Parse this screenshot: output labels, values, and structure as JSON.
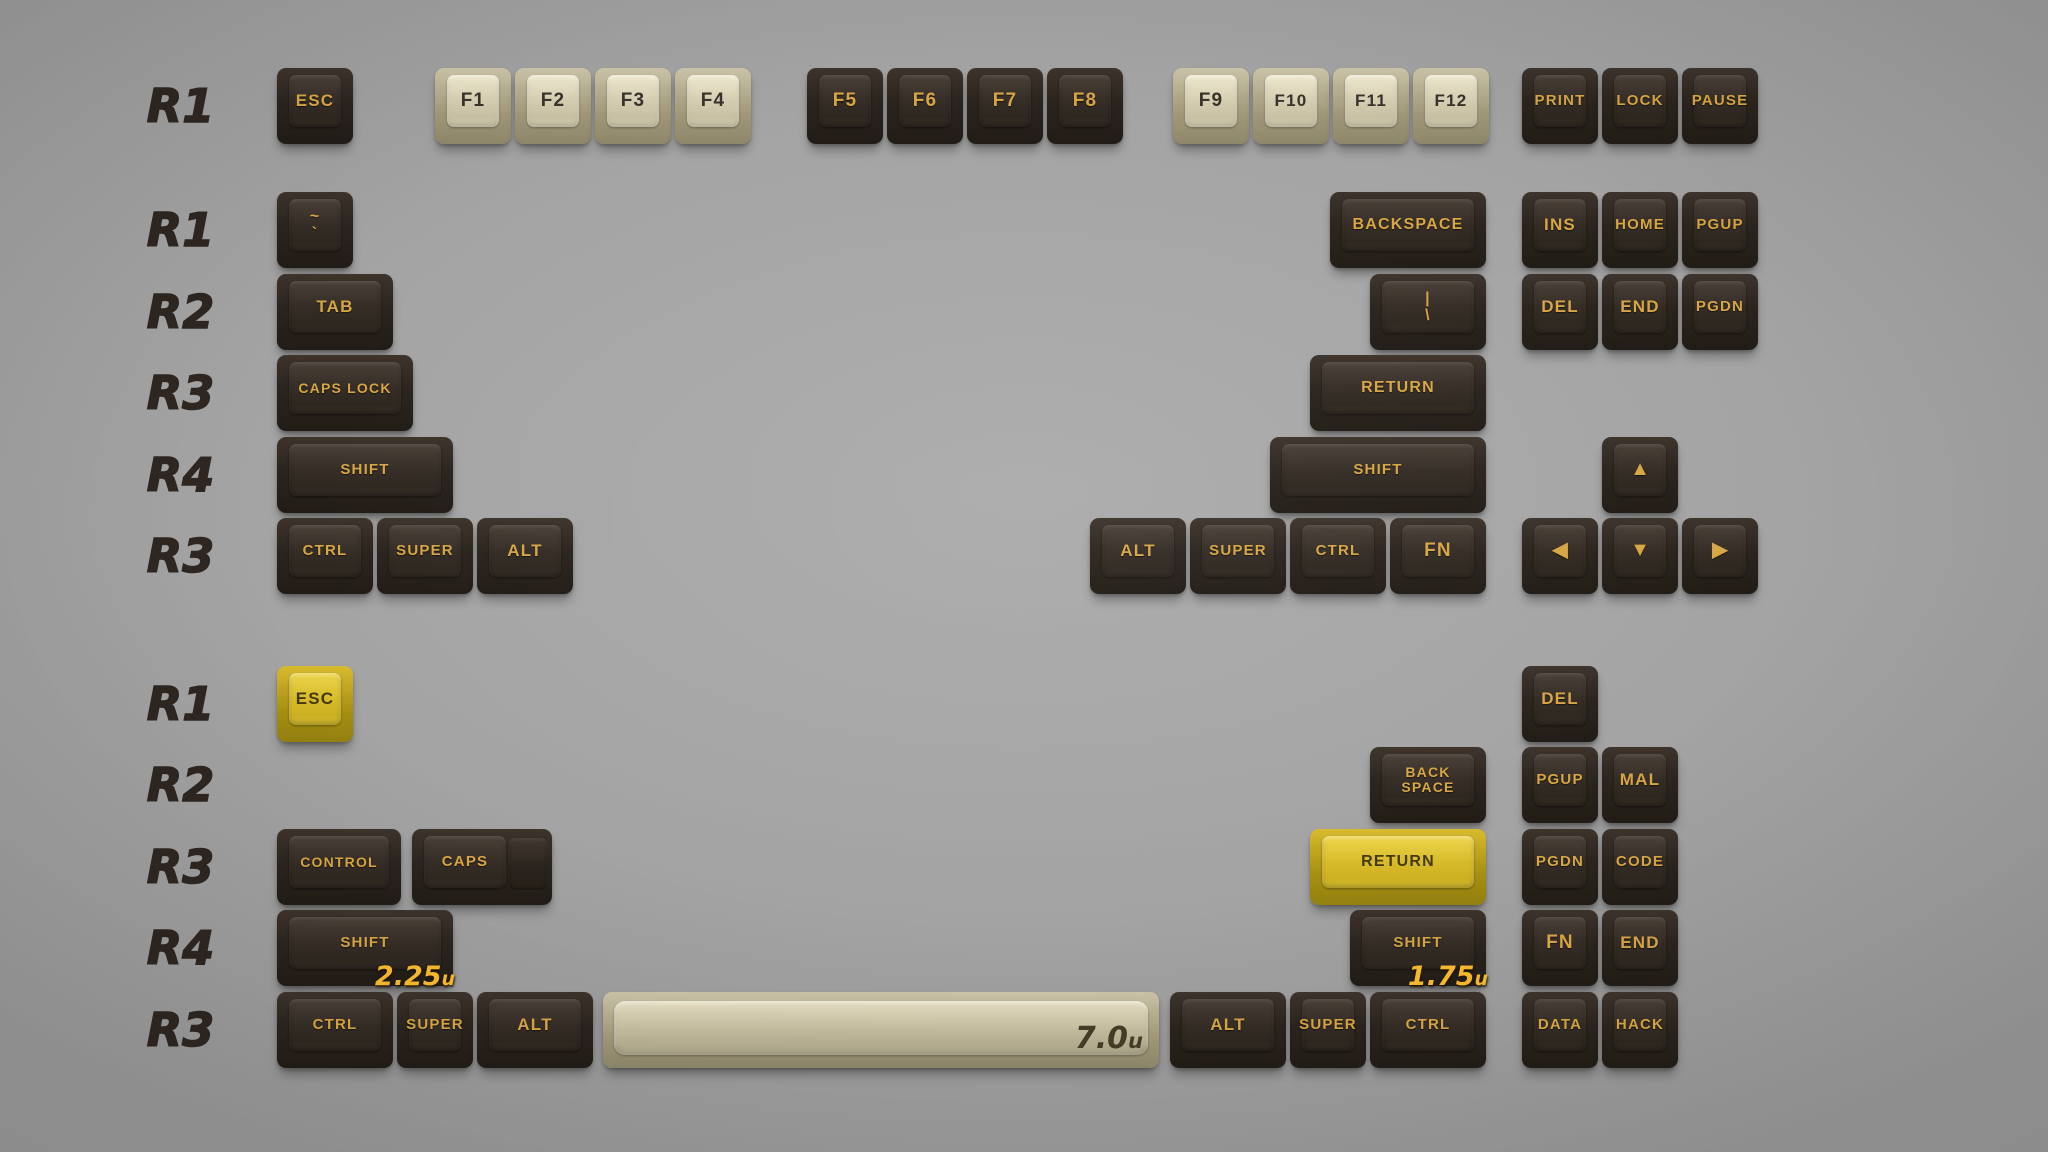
{
  "palette": {
    "background": "#9f9f9f",
    "dark_key": "#2b241e",
    "beige_key": "#d8d1b5",
    "yellow_key": "#dcc135",
    "legend_gold": "#d7a645",
    "legend_dark": "#3a332b",
    "row_label_color": "#2e2620",
    "annotation_yellow": "#f8ba2e",
    "annotation_dark": "#473c28"
  },
  "unit_px": 80,
  "key_height_px": 76,
  "rows": [
    {
      "label": "R1",
      "y": 68,
      "keys": [
        {
          "text": "ESC",
          "x": 277,
          "u": 1,
          "color": "dark"
        },
        {
          "text": "F1",
          "x": 435,
          "u": 1,
          "color": "beige"
        },
        {
          "text": "F2",
          "x": 515,
          "u": 1,
          "color": "beige"
        },
        {
          "text": "F3",
          "x": 595,
          "u": 1,
          "color": "beige"
        },
        {
          "text": "F4",
          "x": 675,
          "u": 1,
          "color": "beige"
        },
        {
          "text": "F5",
          "x": 807,
          "u": 1,
          "color": "dark"
        },
        {
          "text": "F6",
          "x": 887,
          "u": 1,
          "color": "dark"
        },
        {
          "text": "F7",
          "x": 967,
          "u": 1,
          "color": "dark"
        },
        {
          "text": "F8",
          "x": 1047,
          "u": 1,
          "color": "dark"
        },
        {
          "text": "F9",
          "x": 1173,
          "u": 1,
          "color": "beige"
        },
        {
          "text": "F10",
          "x": 1253,
          "u": 1,
          "color": "beige"
        },
        {
          "text": "F11",
          "x": 1333,
          "u": 1,
          "color": "beige"
        },
        {
          "text": "F12",
          "x": 1413,
          "u": 1,
          "color": "beige"
        },
        {
          "text": "PRINT",
          "x": 1522,
          "u": 1,
          "color": "dark"
        },
        {
          "text": "LOCK",
          "x": 1602,
          "u": 1,
          "color": "dark"
        },
        {
          "text": "PAUSE",
          "x": 1682,
          "u": 1,
          "color": "dark"
        }
      ]
    },
    {
      "label": "R1",
      "y": 192,
      "keys": [
        {
          "text": "~ `",
          "id": "tilde",
          "lines": [
            "~",
            "`"
          ],
          "x": 277,
          "u": 1,
          "color": "dark"
        },
        {
          "text": "BACKSPACE",
          "x": 1330,
          "u": 2,
          "color": "dark"
        },
        {
          "text": "INS",
          "x": 1522,
          "u": 1,
          "color": "dark"
        },
        {
          "text": "HOME",
          "x": 1602,
          "u": 1,
          "color": "dark"
        },
        {
          "text": "PGUP",
          "x": 1682,
          "u": 1,
          "color": "dark"
        }
      ]
    },
    {
      "label": "R2",
      "y": 274,
      "keys": [
        {
          "text": "TAB",
          "x": 277,
          "u": 1.5,
          "color": "dark"
        },
        {
          "text": "| \\",
          "id": "backslash",
          "lines": [
            "|",
            "\\"
          ],
          "x": 1370,
          "u": 1.5,
          "color": "dark"
        },
        {
          "text": "DEL",
          "x": 1522,
          "u": 1,
          "color": "dark"
        },
        {
          "text": "END",
          "x": 1602,
          "u": 1,
          "color": "dark"
        },
        {
          "text": "PGDN",
          "x": 1682,
          "u": 1,
          "color": "dark"
        }
      ]
    },
    {
      "label": "R3",
      "y": 355,
      "keys": [
        {
          "text": "CAPS LOCK",
          "x": 277,
          "u": 1.75,
          "color": "dark"
        },
        {
          "text": "RETURN",
          "x": 1310,
          "u": 2.25,
          "color": "dark"
        }
      ]
    },
    {
      "label": "R4",
      "y": 437,
      "keys": [
        {
          "text": "SHIFT",
          "x": 277,
          "u": 2.25,
          "color": "dark"
        },
        {
          "text": "SHIFT",
          "x": 1270,
          "u": 2.75,
          "color": "dark"
        },
        {
          "text": "▲",
          "id": "arrow-up",
          "arrow": true,
          "x": 1602,
          "u": 1,
          "color": "dark"
        }
      ]
    },
    {
      "label": "R3",
      "y": 518,
      "keys": [
        {
          "text": "CTRL",
          "x": 277,
          "u": 1.25,
          "color": "dark"
        },
        {
          "text": "SUPER",
          "x": 377,
          "u": 1.25,
          "color": "dark"
        },
        {
          "text": "ALT",
          "x": 477,
          "u": 1.25,
          "color": "dark"
        },
        {
          "text": "ALT",
          "x": 1090,
          "u": 1.25,
          "color": "dark"
        },
        {
          "text": "SUPER",
          "x": 1190,
          "u": 1.25,
          "color": "dark"
        },
        {
          "text": "CTRL",
          "x": 1290,
          "u": 1.25,
          "color": "dark"
        },
        {
          "text": "FN",
          "x": 1390,
          "u": 1.25,
          "color": "dark"
        },
        {
          "text": "◀",
          "id": "arrow-left",
          "arrow": true,
          "x": 1522,
          "u": 1,
          "color": "dark"
        },
        {
          "text": "▼",
          "id": "arrow-down",
          "arrow": true,
          "x": 1602,
          "u": 1,
          "color": "dark"
        },
        {
          "text": "▶",
          "id": "arrow-right",
          "arrow": true,
          "x": 1682,
          "u": 1,
          "color": "dark"
        }
      ]
    },
    {
      "label": "R1",
      "y": 666,
      "keys": [
        {
          "text": "ESC",
          "id": "esc-yellow",
          "x": 277,
          "u": 1,
          "color": "yellow"
        },
        {
          "text": "DEL",
          "x": 1522,
          "u": 1,
          "color": "dark"
        }
      ]
    },
    {
      "label": "R2",
      "y": 747,
      "keys": [
        {
          "text": "BACK SPACE",
          "id": "back-space",
          "lines": [
            "BACK",
            "SPACE"
          ],
          "x": 1370,
          "u": 1.5,
          "color": "dark"
        },
        {
          "text": "PGUP",
          "x": 1522,
          "u": 1,
          "color": "dark"
        },
        {
          "text": "MAL",
          "x": 1602,
          "u": 1,
          "color": "dark"
        }
      ]
    },
    {
      "label": "R3",
      "y": 829,
      "keys": [
        {
          "text": "CONTROL",
          "x": 277,
          "w": 124,
          "color": "dark"
        },
        {
          "text": "CAPS",
          "id": "caps-stepped",
          "x": 412,
          "w": 140,
          "color": "dark",
          "step": true
        },
        {
          "text": "RETURN",
          "id": "return-yellow",
          "x": 1310,
          "u": 2.25,
          "color": "yellow"
        },
        {
          "text": "PGDN",
          "x": 1522,
          "u": 1,
          "color": "dark"
        },
        {
          "text": "CODE",
          "x": 1602,
          "u": 1,
          "color": "dark"
        }
      ]
    },
    {
      "label": "R4",
      "y": 910,
      "keys": [
        {
          "text": "SHIFT",
          "id": "shift-2-25u",
          "x": 277,
          "u": 2.25,
          "color": "dark",
          "ann": "2.25u",
          "annColor": "yellow"
        },
        {
          "text": "SHIFT",
          "id": "shift-1-75u",
          "x": 1350,
          "u": 1.75,
          "color": "dark",
          "ann": "1.75u",
          "annColor": "yellow"
        },
        {
          "text": "FN",
          "x": 1522,
          "u": 1,
          "color": "dark"
        },
        {
          "text": "END",
          "x": 1602,
          "u": 1,
          "color": "dark"
        }
      ]
    },
    {
      "label": "R3",
      "y": 992,
      "keys": [
        {
          "text": "CTRL",
          "x": 277,
          "u": 1.5,
          "color": "dark"
        },
        {
          "text": "SUPER",
          "x": 397,
          "u": 1,
          "color": "dark"
        },
        {
          "text": "ALT",
          "x": 477,
          "u": 1.5,
          "color": "dark"
        },
        {
          "text": "",
          "id": "spacebar",
          "x": 603,
          "w": 556,
          "color": "beige",
          "space": true,
          "ann": "7.0u",
          "annColor": "dark"
        },
        {
          "text": "ALT",
          "x": 1170,
          "u": 1.5,
          "color": "dark"
        },
        {
          "text": "SUPER",
          "x": 1290,
          "u": 1,
          "color": "dark"
        },
        {
          "text": "CTRL",
          "x": 1370,
          "u": 1.5,
          "color": "dark"
        },
        {
          "text": "DATA",
          "x": 1522,
          "u": 1,
          "color": "dark"
        },
        {
          "text": "HACK",
          "x": 1602,
          "u": 1,
          "color": "dark"
        }
      ]
    }
  ]
}
